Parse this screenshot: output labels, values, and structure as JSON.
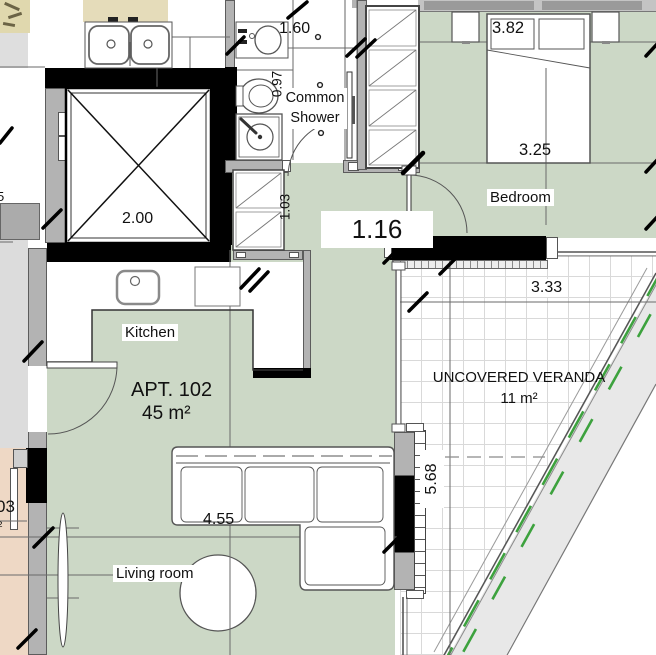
{
  "floor_plan": {
    "apartment": {
      "name": "APT. 102",
      "area": "45 m²"
    },
    "rooms": {
      "kitchen": "Kitchen",
      "bedroom": "Bedroom",
      "living_room": "Living room",
      "shower": "Common Shower",
      "veranda": "UNCOVERED VERANDA",
      "veranda_area": "11 m²"
    },
    "dimensions": {
      "shower_width": "1.60",
      "shower_depth": "0.97",
      "elevator_width": "2.00",
      "bedroom_width": "3.82",
      "bed_length": "3.25",
      "hall_depth": "1.03",
      "hall_width": "1.16",
      "veranda_width": "3.33",
      "living_width": "4.55",
      "veranda_length": "5.68"
    },
    "edge_partials": {
      "neighbor_dim": "03",
      "neighbor_sup": "²",
      "left_dim": "5"
    },
    "colors": {
      "floor_green": "#ccd8c6",
      "veranda_grid": "#d9d9d9",
      "wall_gray": "#b3b3b3",
      "planter_green": "#3da23e",
      "counter_beige": "#e5dcba",
      "neighbor_pink": "#eed8c5"
    }
  }
}
